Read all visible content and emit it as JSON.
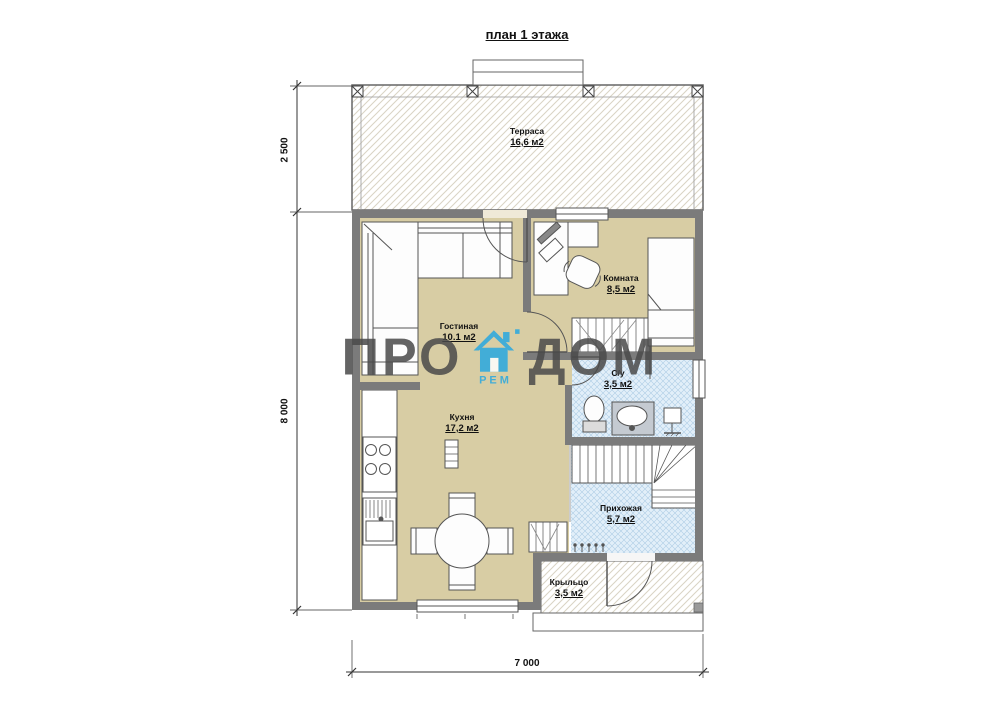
{
  "title": "план 1 этажа",
  "rooms": [
    {
      "name": "Терраса",
      "area": "16,6 м2"
    },
    {
      "name": "Гостиная",
      "area": "10.1 м2"
    },
    {
      "name": "Комната",
      "area": "8,5 м2"
    },
    {
      "name": "С/у",
      "area": "3,5 м2"
    },
    {
      "name": "Кухня",
      "area": "17,2 м2"
    },
    {
      "name": "Прихожая",
      "area": "5,7 м2"
    },
    {
      "name": "Крыльцо",
      "area": "3,5 м2"
    }
  ],
  "dimensions": {
    "left_top": "2 500",
    "left_main": "8 000",
    "bottom": "7 000"
  },
  "watermark": {
    "left": "ПРО",
    "right": "ДОМ",
    "sub": "РЕМ"
  },
  "colors": {
    "wall": "#7b7b7b",
    "floor_beige": "#d8cda4",
    "floor_tile_blue": "#e2eff9",
    "hatch_line": "#d9d3c4",
    "brand_blue": "#29a8e0",
    "watermark_gray": "#4a4a4a"
  }
}
